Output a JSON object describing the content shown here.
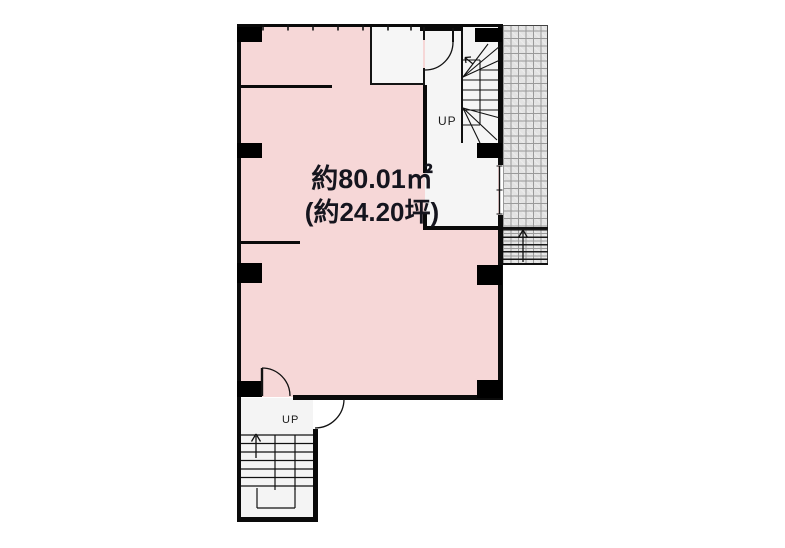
{
  "floorplan": {
    "area": {
      "line1": "約80.01㎡",
      "line2": "(約24.20坪)"
    },
    "stairs": {
      "upper_label": "UP",
      "lower_label": "UP"
    },
    "colors": {
      "room_fill": "#f6d7d7",
      "hall_fill": "#f5f5f5",
      "wall": "#0a0a0a",
      "hatch_fill": "#e3e3e3",
      "hatch_line": "#9a9a9a",
      "label_text": "#15151e"
    }
  }
}
